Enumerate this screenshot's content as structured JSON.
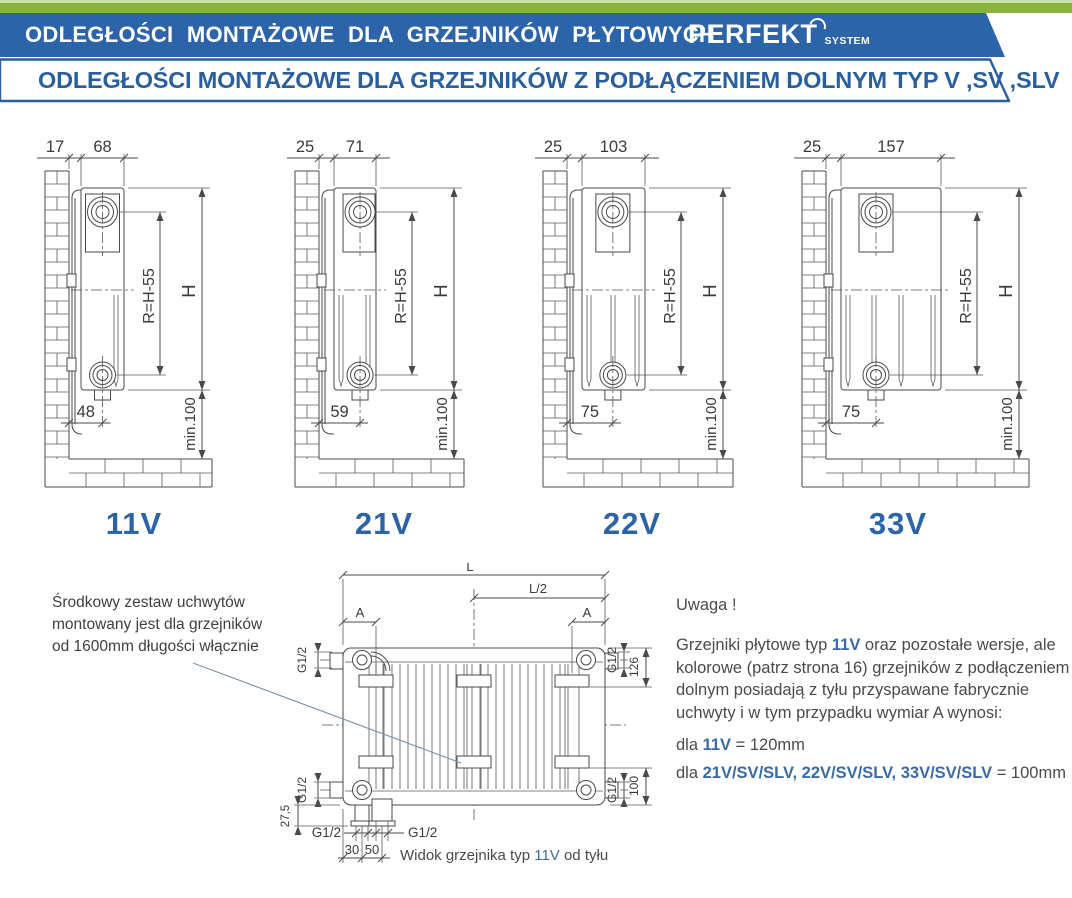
{
  "header": {
    "title": "ODLEGŁOŚCI MONTAŻOWE DLA GRZEJNIKÓW PŁYTOWYCH",
    "brand": "PERFEKT",
    "brand_sub": "SYSTEM",
    "subtitle": "ODLEGŁOŚCI MONTAŻOWE DLA GRZEJNIKÓW Z PODŁĄCZENIEM DOLNYM TYP V ,SV ,SLV"
  },
  "colors": {
    "band_green": "#86b43e",
    "band_blue": "#2b64a8",
    "accent_blue": "#2a5f9e",
    "type_label_blue": "#2c63a9",
    "emphasis_blue": "#3a6ba3"
  },
  "diagrams": [
    {
      "type": "11V",
      "dim_wall": "17",
      "dim_depth": "68",
      "dim_r": "R=H-55",
      "dim_h": "H",
      "dim_bottom": "48",
      "dim_floor": "min.100"
    },
    {
      "type": "21V",
      "dim_wall": "25",
      "dim_depth": "71",
      "dim_r": "R=H-55",
      "dim_h": "H",
      "dim_bottom": "59",
      "dim_floor": "min.100"
    },
    {
      "type": "22V",
      "dim_wall": "25",
      "dim_depth": "103",
      "dim_r": "R=H-55",
      "dim_h": "H",
      "dim_bottom": "75",
      "dim_floor": "min.100"
    },
    {
      "type": "33V",
      "dim_wall": "25",
      "dim_depth": "157",
      "dim_r": "R=H-55",
      "dim_h": "H",
      "dim_bottom": "75",
      "dim_floor": "min.100"
    }
  ],
  "rear": {
    "L": "L",
    "half": "L/2",
    "A1": "A",
    "A2": "A",
    "g12": "G1/2",
    "d126": "126",
    "d100": "100",
    "d275": "27,5",
    "d30": "30",
    "d50": "50",
    "caption_prefix": "Widok grzejnika typ ",
    "caption_type": "11V",
    "caption_suffix": " od tyłu"
  },
  "note_left": {
    "lines": [
      "Środkowy zestaw uchwytów",
      "montowany jest dla grzejników",
      "od 1600mm długości włącznie"
    ]
  },
  "note_right": {
    "heading": "Uwaga !",
    "p1_a": "Grzejniki płytowe typ ",
    "p1_b": "11V",
    "p1_c": " oraz pozostałe wersje, ale kolorowe (patrz strona 16) grzejników z podłączeniem dolnym posiadają z tyłu przyspawane fabrycznie uchwyty i w tym przypadku wymiar A wynosi:",
    "l1_a": "dla ",
    "l1_b": "11V",
    "l1_c": " = 120mm",
    "l2_a": "dla ",
    "l2_b": "21V/SV/SLV, 22V/SV/SLV, 33V/SV/SLV",
    "l2_c": " = 100mm"
  }
}
